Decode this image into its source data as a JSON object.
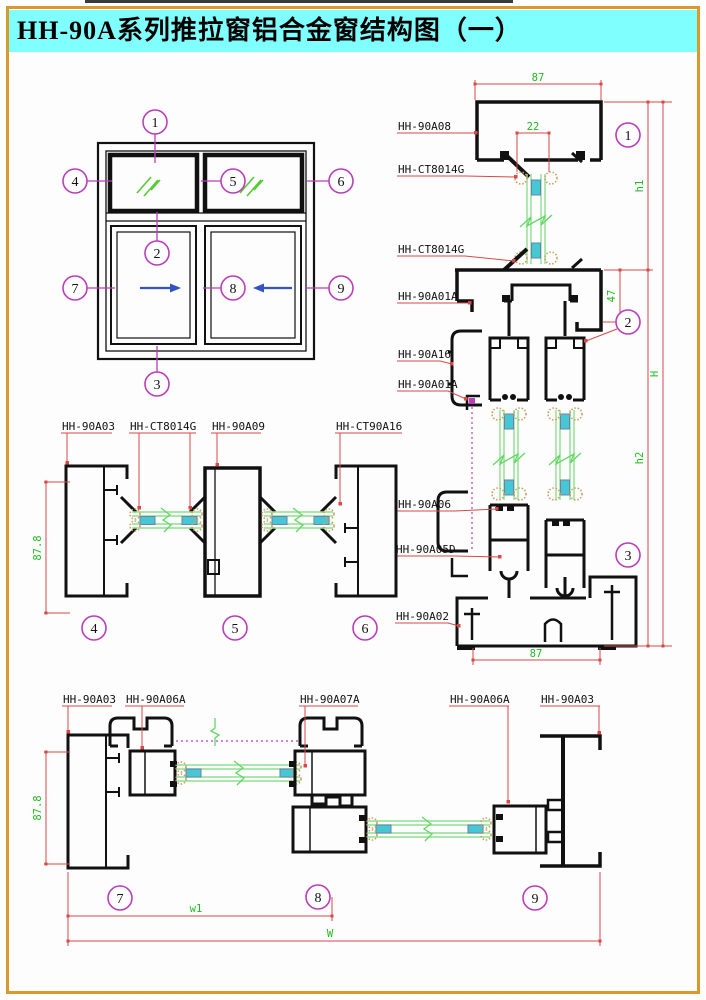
{
  "title": "HH-90A系列推拉窗铝合金窗结构图（一）",
  "callouts": {
    "n1": "1",
    "n2": "2",
    "n3": "3",
    "n4": "4",
    "n5": "5",
    "n6": "6",
    "n7": "7",
    "n8": "8",
    "n9": "9"
  },
  "vertical_section": {
    "labels": [
      "HH-90A08",
      "HH-CT8014G",
      "HH-CT8014G",
      "HH-90A01A",
      "HH-90A16",
      "HH-90A01A",
      "HH-90A06",
      "HH-90A05D",
      "HH-90A02"
    ],
    "dims": {
      "frame_top_width": "87",
      "glazing_width": "22",
      "upper_height": "h1",
      "transom_height": "47",
      "lower_height": "h2",
      "overall_height": "H",
      "frame_bottom_width": "87"
    }
  },
  "mid_section": {
    "labels": [
      "HH-90A03",
      "HH-CT8014G",
      "HH-90A09",
      "HH-CT90A16"
    ],
    "dims": {
      "frame_depth": "87.8"
    }
  },
  "bottom_section": {
    "labels": [
      "HH-90A03",
      "HH-90A06A",
      "HH-90A07A",
      "HH-90A06A",
      "HH-90A03"
    ],
    "dims": {
      "frame_depth": "87.8",
      "sash_width": "w1",
      "overall_width": "W"
    }
  },
  "colors": {
    "border": "#d89a2b",
    "title_bg": "#80ffff",
    "title_text": "#000000",
    "profile": "#111111",
    "dimension_line": "#d94848",
    "dimension_text": "#1fbb1f",
    "callout": "#bb3dbb",
    "glass": "#8fe08f",
    "slide_arrow": "#3352c4",
    "spacer": "#45c8d4",
    "gasket": "#c9a063"
  }
}
